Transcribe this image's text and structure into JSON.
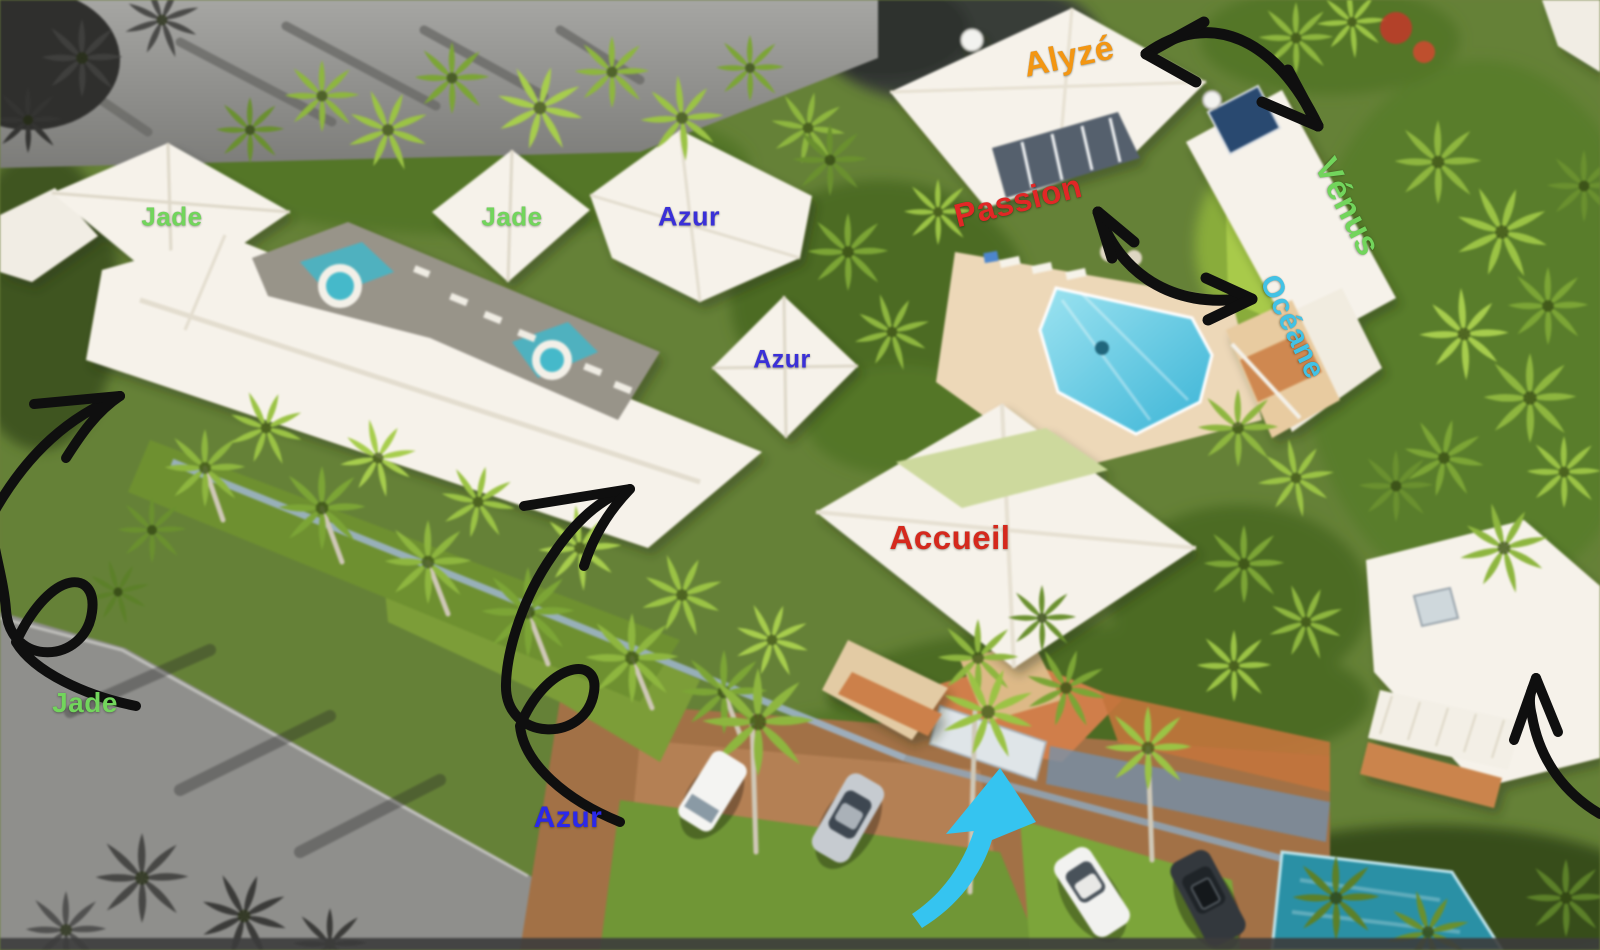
{
  "property_map": {
    "title_note": "",
    "labels": [
      {
        "id": "jade-1",
        "text": "Jade",
        "color": "#72d55c",
        "x": 172,
        "y": 217,
        "size": 26,
        "rotate": 0
      },
      {
        "id": "jade-2",
        "text": "Jade",
        "color": "#72d55c",
        "x": 512,
        "y": 217,
        "size": 26,
        "rotate": 0
      },
      {
        "id": "azur-1",
        "text": "Azur",
        "color": "#3a30d8",
        "x": 689,
        "y": 217,
        "size": 27,
        "rotate": 0
      },
      {
        "id": "azur-2",
        "text": "Azur",
        "color": "#3a30d8",
        "x": 782,
        "y": 360,
        "size": 25,
        "rotate": 0
      },
      {
        "id": "alyze",
        "text": "Alyzé",
        "color": "#f39612",
        "x": 1069,
        "y": 57,
        "size": 34,
        "rotate": -12
      },
      {
        "id": "passion",
        "text": "Passion",
        "color": "#e12726",
        "x": 1018,
        "y": 201,
        "size": 33,
        "rotate": -14
      },
      {
        "id": "venus",
        "text": "Vénus",
        "color": "#72d55c",
        "x": 1347,
        "y": 207,
        "size": 34,
        "rotate": 63
      },
      {
        "id": "oceane",
        "text": "Océane",
        "color": "#42c2e5",
        "x": 1292,
        "y": 327,
        "size": 30,
        "rotate": 64
      },
      {
        "id": "accueil",
        "text": "Accueil",
        "color": "#d5291d",
        "x": 950,
        "y": 538,
        "size": 33,
        "rotate": 0
      },
      {
        "id": "jade-3",
        "text": "Jade",
        "color": "#72d55c",
        "x": 85,
        "y": 703,
        "size": 28,
        "rotate": 0
      },
      {
        "id": "azur-3",
        "text": "Azur",
        "color": "#2b28ea",
        "x": 568,
        "y": 818,
        "size": 30,
        "rotate": 0
      }
    ],
    "annotations": {
      "sketch_arrow_color": "#0f0f0f",
      "entrance_arrow_color": "#35c4f0",
      "arrows": [
        {
          "id": "arrow-to-jade-building"
        },
        {
          "id": "arrow-to-azur-building"
        },
        {
          "id": "link-alyze-venus"
        },
        {
          "id": "link-passion-oceane"
        },
        {
          "id": "arrow-to-bottom-right-building"
        },
        {
          "id": "entrance-arrow"
        }
      ]
    },
    "scene_palette": {
      "pool_water": "#4fc0dc",
      "roofs": "#f6f2ea",
      "lawn": "#7d9c3c",
      "road_gray": "#8f8f8c",
      "driveway_orange": "#cd7f4d"
    }
  }
}
